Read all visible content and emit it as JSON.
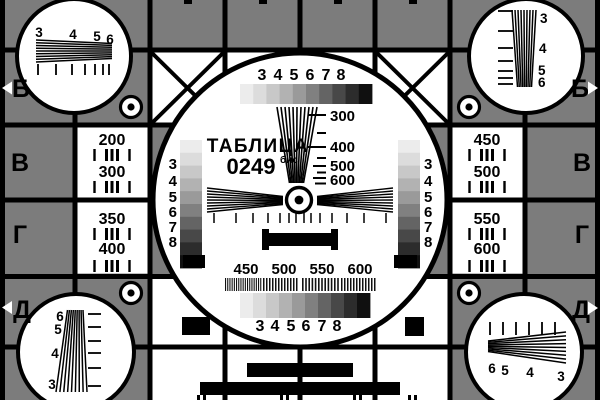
{
  "card": {
    "title": "ТАБЛИЦА",
    "number": "0249",
    "number_suffix": "бис"
  },
  "colors": {
    "gray": "#7c7c7c",
    "black": "#000000",
    "white": "#ffffff",
    "grayscale_steps": [
      "#ececec",
      "#dcdcdc",
      "#c8c8c8",
      "#b2b2b2",
      "#9a9a9a",
      "#808080",
      "#646464",
      "#484848",
      "#2c2c2c",
      "#101010"
    ]
  },
  "edge_labels": {
    "left": [
      "Б",
      "В",
      "Г",
      "Д"
    ],
    "right": [
      "Б",
      "В",
      "Г",
      "Д"
    ]
  },
  "corners": {
    "top_left": {
      "numbers": [
        "3",
        "4",
        "5",
        "6"
      ]
    },
    "top_right": {
      "numbers": [
        "3",
        "4",
        "5",
        "6"
      ]
    },
    "bottom_left": {
      "numbers": [
        "6",
        "5",
        "4",
        "3"
      ]
    },
    "bottom_right": {
      "numbers": [
        "6",
        "5",
        "4",
        "3"
      ]
    }
  },
  "panels": {
    "left_upper": [
      "200",
      "300"
    ],
    "left_lower": [
      "350",
      "400"
    ],
    "right_upper": [
      "450",
      "500"
    ],
    "right_lower": [
      "550",
      "600"
    ]
  },
  "center": {
    "top_numbers": [
      "3",
      "4",
      "5",
      "6",
      "7",
      "8"
    ],
    "wedge_labels": [
      "300",
      "400",
      "500",
      "600"
    ],
    "left_column_numbers": [
      "3",
      "4",
      "5",
      "6",
      "7",
      "8"
    ],
    "right_column_numbers": [
      "3",
      "4",
      "5",
      "6",
      "7",
      "8"
    ],
    "bottom_labels": [
      "450",
      "500",
      "550",
      "600"
    ],
    "bottom_numbers": [
      "3",
      "4",
      "5",
      "6",
      "7",
      "8"
    ]
  }
}
